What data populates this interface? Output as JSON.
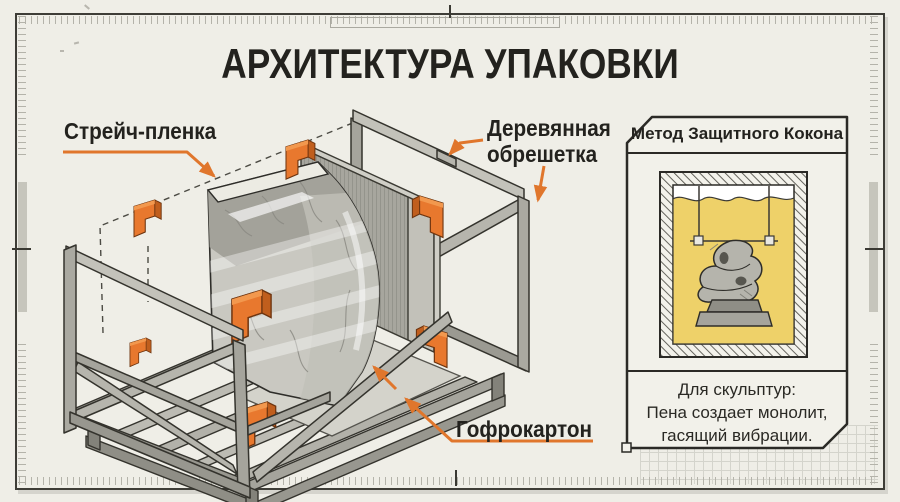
{
  "title": "АРХИТЕКТУРА УПАКОВКИ",
  "diagram": {
    "labels": {
      "stretch_film": "Стрейч-пленка",
      "wooden_crate_line1": "Деревянная",
      "wooden_crate_line2": "обрешетка",
      "cardboard": "Гофрокартон"
    }
  },
  "side_panel": {
    "header": "Метод Защитного Кокона",
    "body_line1": "Для скульптур:",
    "body_line2": "Пена создает монолит,",
    "body_line3": "гасящий вибрации."
  },
  "colors": {
    "accent_orange": "#e0762c",
    "ink": "#23221e",
    "paper": "#efeee7",
    "foam_yellow": "#eed169",
    "wood_gray": "#b2b1a9"
  }
}
